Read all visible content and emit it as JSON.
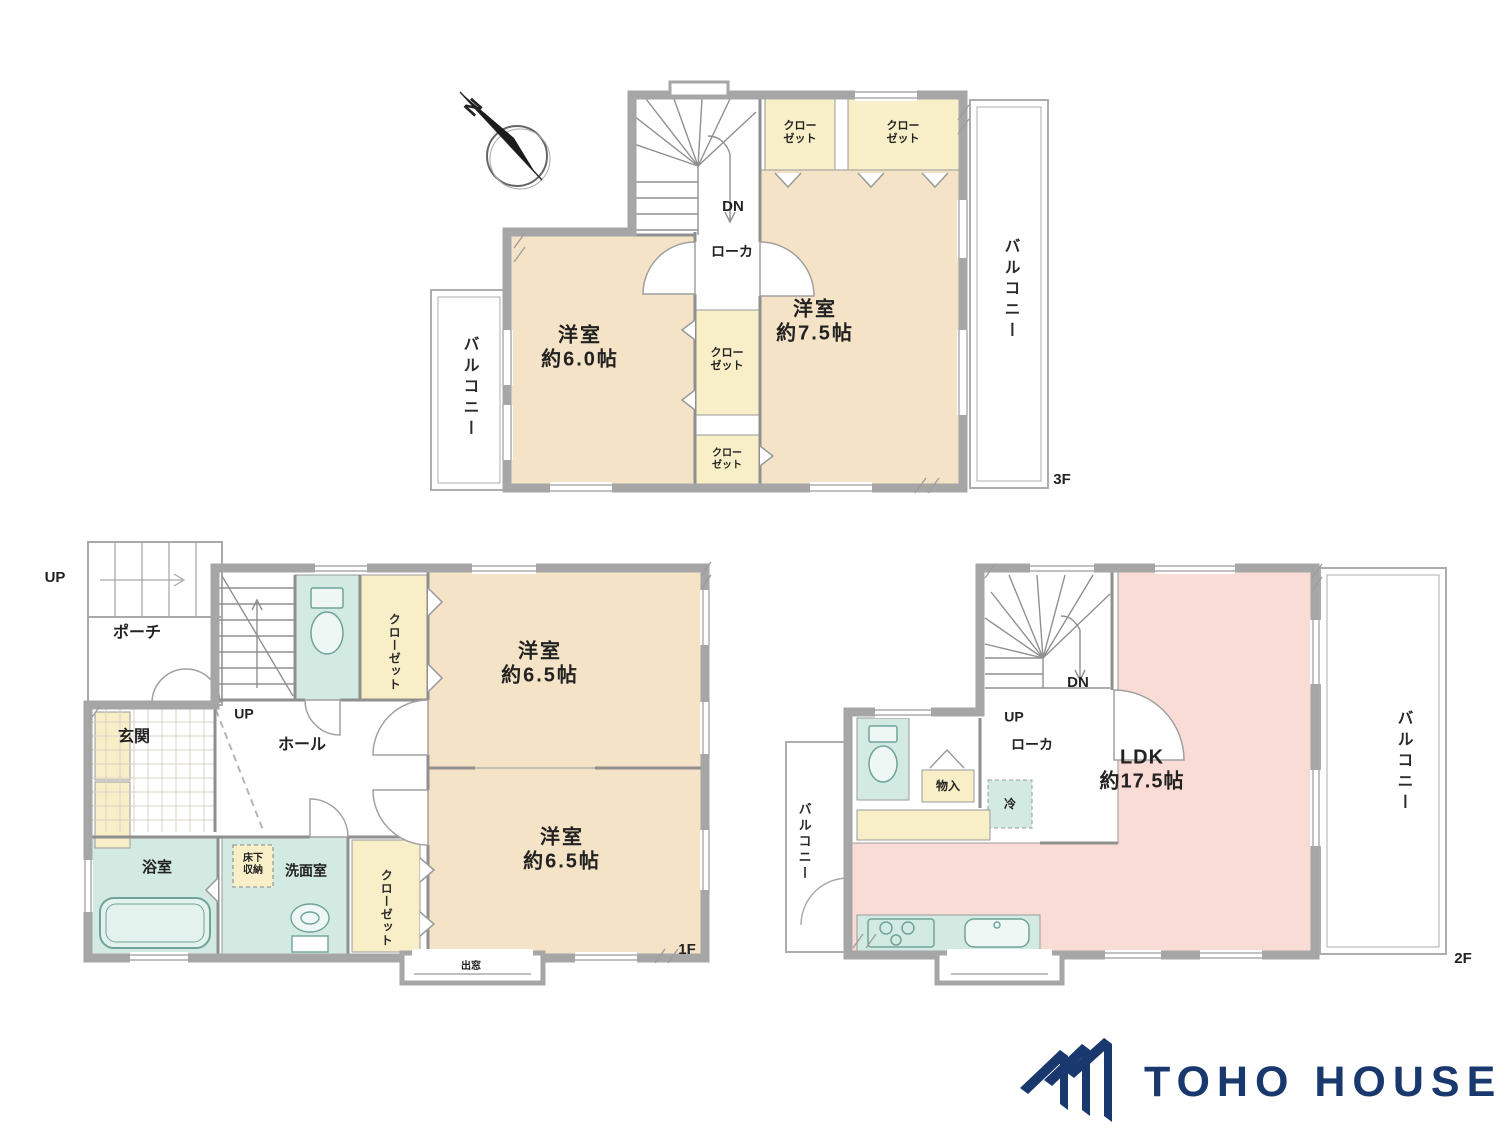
{
  "compass": {
    "north": "N"
  },
  "colors": {
    "room_beige": "#f4e3c6",
    "closet_yellow": "#f8efc8",
    "wet_area_teal": "#d2eae2",
    "ldk_pink": "#f9dcd5",
    "wall_gray": "#a6a6a6",
    "logo_navy": "#19386e"
  },
  "floors": {
    "f3": {
      "label": "3F",
      "bedroom_left_name": "洋室",
      "bedroom_left_size": "約6.0帖",
      "bedroom_right_name": "洋室",
      "bedroom_right_size": "約7.5帖",
      "closet_line1": "クロー",
      "closet_line2": "ゼット",
      "balcony": "バルコニー",
      "corridor": "ローカ",
      "down": "DN"
    },
    "f1": {
      "label": "1F",
      "up_outside": "UP",
      "up_stairs": "UP",
      "porch": "ポーチ",
      "entrance": "玄関",
      "hall": "ホール",
      "closet": "クローゼット",
      "bedroom_top_name": "洋室",
      "bedroom_top_size": "約6.5帖",
      "bedroom_bottom_name": "洋室",
      "bedroom_bottom_size": "約6.5帖",
      "bathroom": "浴室",
      "underfloor_line1": "床下",
      "underfloor_line2": "収納",
      "washroom": "洗面室",
      "bay_window": "出窓"
    },
    "f2": {
      "label": "2F",
      "down": "DN",
      "up": "UP",
      "corridor": "ローカ",
      "storage": "物入",
      "fridge": "冷",
      "ldk_name": "LDK",
      "ldk_size": "約17.5帖",
      "balcony": "バルコニー"
    }
  },
  "logo": {
    "brand": "TOHO HOUSE"
  }
}
